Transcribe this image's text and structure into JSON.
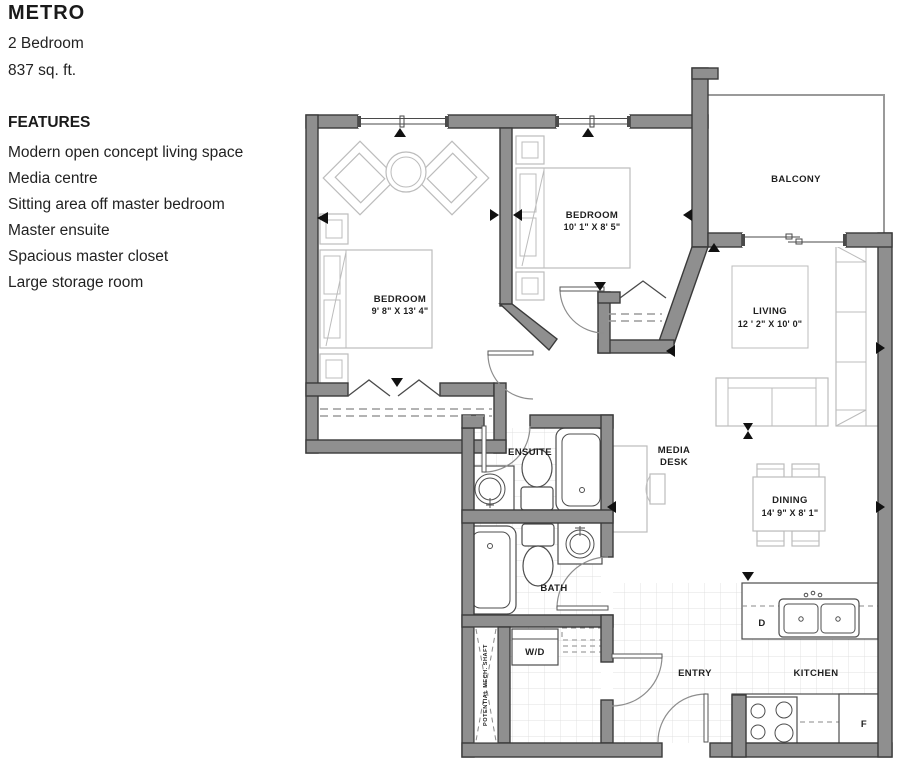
{
  "header": {
    "title": "METRO",
    "subtitle": "2 Bedroom",
    "area": "837 sq. ft."
  },
  "features": {
    "heading": "FEATURES",
    "items": [
      "Modern open concept living space",
      "Media centre",
      "Sitting area off master bedroom",
      "Master ensuite",
      "Spacious master closet",
      "Large storage room"
    ]
  },
  "plan": {
    "balcony_label": "BALCONY",
    "master_bedroom": {
      "name": "BEDROOM",
      "dims": "9' 8\" X 13' 4\""
    },
    "bedroom2": {
      "name": "BEDROOM",
      "dims": "10' 1\" X 8' 5\""
    },
    "living": {
      "name": "LIVING",
      "dims": "12 ' 2\" X 10' 0\""
    },
    "dining": {
      "name": "DINING",
      "dims": "14' 9\" X 8' 1\""
    },
    "ensuite_label": "ENSUITE",
    "bath_label": "BATH",
    "media_desk": {
      "line1": "MEDIA",
      "line2": "DESK"
    },
    "wd_label": "W/D",
    "entry_label": "ENTRY",
    "kitchen_label": "KITCHEN",
    "dishwasher_label": "D",
    "fridge_label": "F",
    "mech_shaft_label": "POTENTIAL MECH. SHAFT"
  },
  "colors": {
    "wall_fill": "#8f8f8f",
    "wall_stroke": "#3a3a3a",
    "furniture_stroke": "#bcbcbc",
    "fixture_stroke": "#4d4d4d",
    "tile_line": "#e0e0e0",
    "text": "#1f1f1f"
  }
}
